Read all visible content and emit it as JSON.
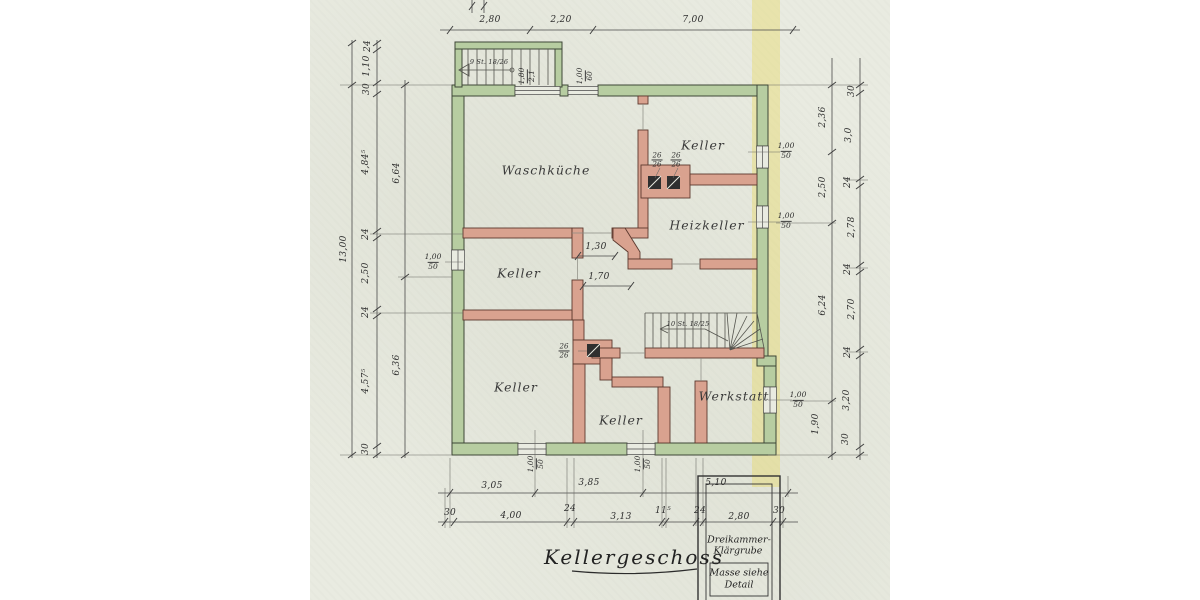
{
  "plan": {
    "title": "Kellergeschoss",
    "rooms": [
      {
        "name": "Waschküche"
      },
      {
        "name": "Keller"
      },
      {
        "name": "Heizkeller"
      },
      {
        "name": "Keller"
      },
      {
        "name": "Keller"
      },
      {
        "name": "Keller"
      },
      {
        "name": "Werkstatt"
      }
    ],
    "stairs": {
      "top": "9 St. 18/26",
      "interior": "10 St. 18/25"
    },
    "dims": {
      "top": [
        "2,80",
        "2,20",
        "7,00"
      ],
      "left_total": "13,00",
      "left_chain": [
        "24",
        "1,10",
        "30",
        "4,84⁵",
        "24",
        "2,50",
        "24",
        "4,57⁵",
        "30"
      ],
      "left_inner": [
        "6,64",
        "6,36"
      ],
      "right_outer": [
        "2,36",
        "2,50",
        "6,24",
        "1,90"
      ],
      "right_inner": [
        "30",
        "3,0",
        "24",
        "2,78",
        "24",
        "2,70",
        "24",
        "3,20",
        "30"
      ],
      "bottom_upper": [
        "3,05",
        "3,85",
        "5,10"
      ],
      "bottom_lower": [
        "30",
        "4,00",
        "24",
        "3,13",
        "11⁵",
        "24",
        "2,80",
        "30"
      ],
      "interior": [
        "1,30",
        "1,70"
      ]
    },
    "window_labels": [
      {
        "num": "1,00",
        "den": "50"
      },
      {
        "num": "1,00",
        "den": "50"
      },
      {
        "num": "1,00",
        "den": "50"
      },
      {
        "num": "1,00",
        "den": "50"
      },
      {
        "num": "1,00",
        "den": "50"
      },
      {
        "num": "1,00",
        "den": "50"
      },
      {
        "num": "1,00",
        "den": "60"
      },
      {
        "num": "1,80",
        "den": "2,1"
      }
    ],
    "chimney_labels": [
      {
        "num": "26",
        "den": "26"
      },
      {
        "num": "26",
        "den": "26"
      },
      {
        "num": "26",
        "den": "26"
      }
    ],
    "klaergrube": {
      "line1": "Dreikammer-",
      "line2": "Klärgrube",
      "note_line1": "Masse siehe",
      "note_line2": "Detail"
    },
    "colors": {
      "paper": "#e9ebe1",
      "exterior_wall": "#b7cda1",
      "interior_wall": "#d9a28f",
      "highlight": "#e8d964",
      "ink": "#3f3f3f"
    }
  }
}
